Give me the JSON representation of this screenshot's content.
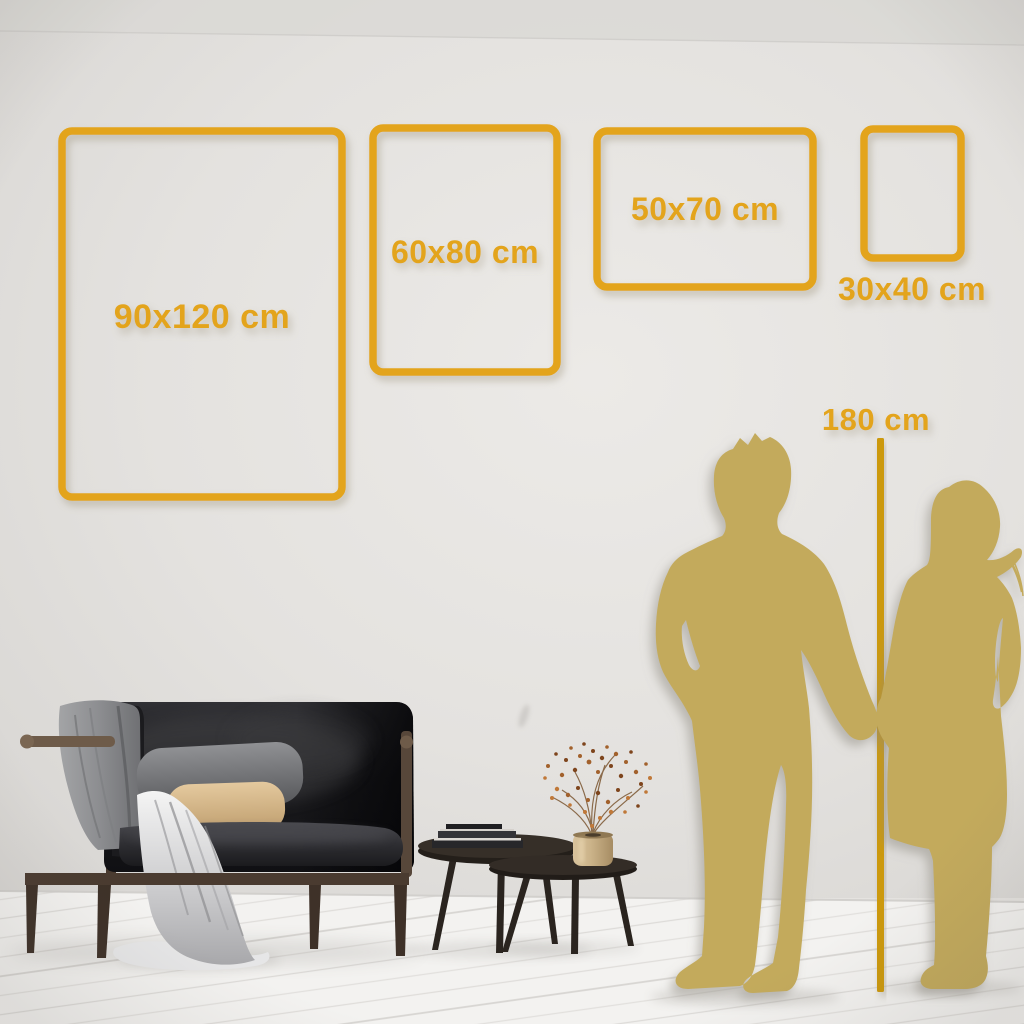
{
  "size_guide": {
    "frames": [
      {
        "id": "90x120",
        "label": "90x120 cm"
      },
      {
        "id": "60x80",
        "label": "60x80 cm"
      },
      {
        "id": "50x70",
        "label": "50x70 cm"
      },
      {
        "id": "30x40",
        "label": "30x40 cm"
      }
    ],
    "height_reference": {
      "label": "180 cm"
    }
  },
  "colors": {
    "accent_gold": "#E3A41C",
    "measure_line_gold": "#CC9910",
    "silhouette_gold": "#C3AA5B",
    "wall": "#E5E3E0",
    "floor": "#F3F2F0"
  },
  "scene": {
    "objects": [
      "dark-velvet-sofa",
      "gray-throw-blanket",
      "back-cushion",
      "beige-accent-pillow",
      "white-drape-cloth",
      "nesting-coffee-tables",
      "stacked-books",
      "brass-vase-with-dried-flowers",
      "couple-silhouette",
      "height-measure-line",
      "whitewashed-plank-floor"
    ]
  }
}
